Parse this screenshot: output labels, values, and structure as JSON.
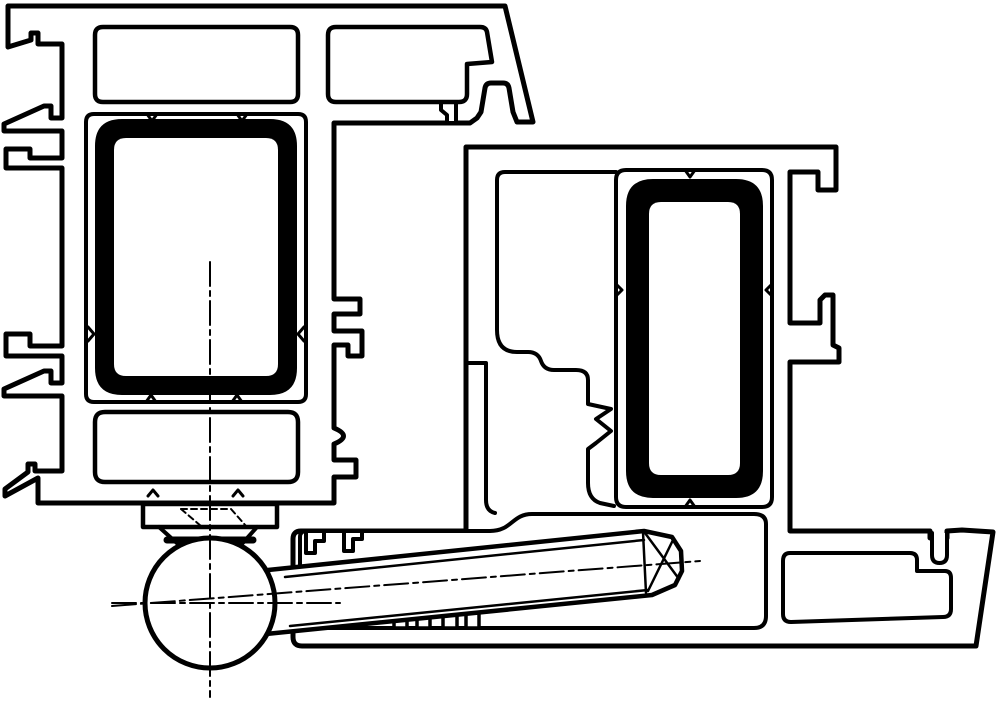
{
  "canvas": {
    "width": 1000,
    "height": 702,
    "background": "#ffffff"
  },
  "colors": {
    "line": "#000000",
    "fill": "#ffffff",
    "reinforcement": "#000000"
  },
  "drawing": {
    "kind": "technical-cross-section",
    "subject": "door-window-profile-hinge-section",
    "shapes": [
      {
        "name": "sash-profile-outline",
        "type": "path",
        "fill": "#ffffff",
        "sw": 5,
        "d": "M 8,6 L 505,6 L 533,122 L 517,122 L 513,112 L 509,88 Q 508,83 503,83 L 491,83 Q 486,83 485,88 L 481,112 L 477,118 L 470,123 L 334,123 L 334,299 L 360,299 L 360,314 L 334,314 L 334,331 L 362,331 L 362,356 L 348,356 L 348,345 L 334,345 L 334,428 Q 353,436 334,444 L 334,460 L 356,460 L 356,477 L 334,477 L 334,503 L 38,503 L 38,478 L 5,496 L 5,489 L 28,472 L 28,464 L 35,464 L 35,471 L 62,471 L 62,396 L 4,396 L 4,389 L 44,371 L 51,371 L 51,383 L 62,383 L 62,356 L 6,356 L 6,334 L 30,334 L 30,346 L 62,346 L 62,168 L 6,168 L 6,149 L 30,149 L 30,158 L 62,158 L 62,131 L 4,131 L 4,124 L 44,106 L 51,106 L 51,118 L 62,118 L 62,44 L 38,44 L 38,33 L 31,33 L 31,40 L 8,47 Z"
      },
      {
        "name": "sash-bead-hook",
        "type": "path",
        "fill": "#ffffff",
        "sw": 4,
        "d": "M 456,123 L 456,100 Q 456,92 448,92 Q 441,92 441,100 L 441,110 L 447,115 L 447,123 Z"
      },
      {
        "name": "sash-top-chamber-1",
        "type": "path",
        "fill": "#ffffff",
        "sw": 4.5,
        "d": "M 103,27 L 290,27 Q 298,27 298,35 L 298,94 Q 298,102 290,102 L 103,102 Q 95,102 95,94 L 95,35 Q 95,27 103,27 Z"
      },
      {
        "name": "sash-top-chamber-2",
        "type": "path",
        "fill": "#ffffff",
        "sw": 4.5,
        "d": "M 336,27 L 480,27 Q 486,27 487,32 L 492,62 L 467,64 L 467,94 Q 467,102 459,102 L 336,102 Q 328,102 328,94 L 328,35 Q 328,27 336,27 Z"
      },
      {
        "name": "sash-reinforcement-chamber",
        "type": "path",
        "fill": "#ffffff",
        "sw": 4,
        "d": "M 94,114 L 298,114 Q 306,114 306,122 L 306,394 Q 306,402 298,402 L 94,402 Q 86,402 86,394 L 86,122 Q 86,114 94,114 Z"
      },
      {
        "name": "steel-reinforcement-sash",
        "type": "path",
        "fill": "#000000",
        "stroke": "#000000",
        "sw": 2,
        "d": "M 122,120 L 270,120 Q 296,120 296,146 L 296,368 Q 296,394 270,394 L 122,394 Q 96,394 96,368 L 96,146 Q 96,120 122,120 Z"
      },
      {
        "name": "steel-reinforcement-sash-core",
        "type": "path",
        "fill": "#ffffff",
        "stroke": "none",
        "sw": 0,
        "d": "M 126,138 L 266,138 Q 278,138 278,150 L 278,364 Q 278,376 266,376 L 126,376 Q 114,376 114,364 L 114,150 Q 114,138 126,138 Z"
      },
      {
        "name": "sash-lower-chamber",
        "type": "path",
        "fill": "#ffffff",
        "sw": 4.5,
        "d": "M 105,412 L 288,412 Q 298,412 298,422 L 298,472 Q 298,482 288,482 L 105,482 Q 95,482 95,472 L 95,422 Q 95,412 105,412 Z"
      },
      {
        "name": "weld-notch-1",
        "type": "path",
        "fill": "none",
        "sw": 3,
        "d": "M 147,114 L 152,121 L 157,114"
      },
      {
        "name": "weld-notch-2",
        "type": "path",
        "fill": "none",
        "sw": 3,
        "d": "M 237,114 L 242,121 L 247,114"
      },
      {
        "name": "weld-notch-3",
        "type": "path",
        "fill": "none",
        "sw": 3,
        "d": "M 146,402 L 151,395 L 156,402"
      },
      {
        "name": "weld-notch-4",
        "type": "path",
        "fill": "none",
        "sw": 3,
        "d": "M 232,402 L 237,395 L 242,402"
      },
      {
        "name": "weld-notch-5",
        "type": "path",
        "fill": "none",
        "sw": 3,
        "d": "M 88,327 L 94,334 L 88,341"
      },
      {
        "name": "weld-notch-6",
        "type": "path",
        "fill": "none",
        "sw": 3,
        "d": "M 304,327 L 298,334 L 304,341"
      },
      {
        "name": "weld-notch-7",
        "type": "path",
        "fill": "none",
        "sw": 3,
        "d": "M 148,496 L 153,490 L 158,496"
      },
      {
        "name": "weld-notch-8",
        "type": "path",
        "fill": "none",
        "sw": 3,
        "d": "M 233,496 L 238,490 L 243,496"
      },
      {
        "name": "hinge-mount-plate",
        "type": "path",
        "fill": "#ffffff",
        "sw": 4.5,
        "d": "M 143,504 L 277,504 L 277,527 L 143,527 Z"
      },
      {
        "name": "hinge-mount-hidden-edge-1",
        "type": "path",
        "fill": "none",
        "sw": 2,
        "dash": "6 4",
        "d": "M 181,509 L 231,509"
      },
      {
        "name": "hinge-mount-hidden-edge-2",
        "type": "path",
        "fill": "none",
        "sw": 2,
        "dash": "6 4",
        "d": "M 181,509 L 201,526"
      },
      {
        "name": "hinge-mount-hidden-edge-3",
        "type": "path",
        "fill": "none",
        "sw": 2,
        "dash": "6 4",
        "d": "M 231,509 L 246,526"
      },
      {
        "name": "hinge-mount-hidden-edge-4",
        "type": "path",
        "fill": "none",
        "sw": 2,
        "dash": "6 4",
        "d": "M 206,526 L 219,526"
      },
      {
        "name": "hinge-mount-taper-left",
        "type": "path",
        "fill": "none",
        "sw": 4,
        "d": "M 159,527 L 179,545"
      },
      {
        "name": "hinge-mount-taper-right",
        "type": "path",
        "fill": "none",
        "sw": 4,
        "d": "M 257,527 L 241,545"
      },
      {
        "name": "hinge-mount-contact-band",
        "type": "path",
        "fill": "none",
        "sw": 7,
        "d": "M 167,540 L 253,540"
      },
      {
        "name": "frame-profile-outline",
        "type": "path",
        "fill": "#ffffff",
        "sw": 5,
        "d": "M 466,147 L 836,147 L 836,190 L 818,190 L 818,172 L 790,172 L 790,323 L 820,323 L 820,300 L 825,295 L 833,295 L 833,345 L 839,348 L 839,362 L 790,362 L 790,531 L 930,531 L 930,538 L 947,538 L 947,531 L 962,530 L 993,532 L 976,646 L 302,646 Q 293,646 293,637 L 293,539 Q 293,531 301,531 L 466,531 Z"
      },
      {
        "name": "frame-main-chamber",
        "type": "path",
        "fill": "none",
        "sw": 4,
        "d": "M 616,172 L 505,172 Q 497,172 497,180 L 497,330 Q 497,352 517,352 L 528,352 Q 538,352 541,361 Q 544,370 554,370 L 576,370 Q 588,370 588,380 L 588,404 L 611,409 L 596,419 L 611,431 L 596,443 L 588,449 L 588,483 Q 588,499 600,503 L 614,506"
      },
      {
        "name": "frame-foot-step",
        "type": "path",
        "fill": "none",
        "sw": 4,
        "d": "M 466,363 L 486,363 L 486,500 Q 486,511 495,513"
      },
      {
        "name": "frame-reinforcement-chamber",
        "type": "path",
        "fill": "#ffffff",
        "sw": 4,
        "d": "M 626,170 L 762,170 Q 772,170 772,180 L 772,497 Q 772,507 762,507 L 626,507 Q 616,507 616,497 L 616,180 Q 616,170 626,170 Z"
      },
      {
        "name": "steel-reinforcement-frame",
        "type": "path",
        "fill": "#000000",
        "stroke": "#000000",
        "sw": 2,
        "d": "M 653,180 L 736,180 Q 762,180 762,206 L 762,471 Q 762,497 736,497 L 653,497 Q 627,497 627,471 L 627,206 Q 627,180 653,180 Z"
      },
      {
        "name": "steel-reinforcement-frame-core",
        "type": "path",
        "fill": "#ffffff",
        "stroke": "none",
        "sw": 0,
        "d": "M 661,202 L 728,202 Q 740,202 740,214 L 740,463 Q 740,475 728,475 L 661,475 Q 649,475 649,463 L 649,214 Q 649,202 661,202 Z"
      },
      {
        "name": "weld-notch-9",
        "type": "path",
        "fill": "none",
        "sw": 3,
        "d": "M 685,170 L 690,177 L 695,170"
      },
      {
        "name": "weld-notch-10",
        "type": "path",
        "fill": "none",
        "sw": 3,
        "d": "M 616,284 L 622,290 L 616,296"
      },
      {
        "name": "weld-notch-11",
        "type": "path",
        "fill": "none",
        "sw": 3,
        "d": "M 772,284 L 766,290 L 772,296"
      },
      {
        "name": "weld-notch-12",
        "type": "path",
        "fill": "none",
        "sw": 3,
        "d": "M 685,507 L 690,500 L 695,507"
      },
      {
        "name": "threshold-chamber",
        "type": "path",
        "fill": "#ffffff",
        "sw": 4,
        "d": "M 306,531 L 490,531 C 512,531 512,514 532,514 L 754,514 Q 766,514 766,524 L 766,616 Q 766,628 754,628 L 310,628 Q 300,628 300,618 L 300,537 Q 300,531 306,531 Z"
      },
      {
        "name": "threshold-rib-1",
        "type": "rect",
        "x": 394,
        "y": 614,
        "w": 13,
        "h": 14,
        "fill": "#ffffff",
        "sw": 3.5
      },
      {
        "name": "threshold-rib-2",
        "type": "rect",
        "x": 417,
        "y": 614,
        "w": 13,
        "h": 14,
        "fill": "#ffffff",
        "sw": 3.5
      },
      {
        "name": "threshold-rib-3",
        "type": "rect",
        "x": 443,
        "y": 613,
        "w": 14,
        "h": 15,
        "fill": "#ffffff",
        "sw": 3.5
      },
      {
        "name": "threshold-rib-4",
        "type": "rect",
        "x": 466,
        "y": 613,
        "w": 13,
        "h": 15,
        "fill": "#ffffff",
        "sw": 3.5
      },
      {
        "name": "threshold-right-chamber",
        "type": "path",
        "fill": "#ffffff",
        "sw": 4,
        "d": "M 790,553 L 910,553 Q 917,553 917,560 L 917,571 L 945,571 Q 951,571 951,578 L 951,609 Q 951,617 943,617 L 791,622 Q 783,622 783,614 L 783,561 Q 783,553 790,553 Z"
      },
      {
        "name": "threshold-gasket-slot",
        "type": "path",
        "fill": "#ffffff",
        "sw": 4,
        "d": "M 932,533 L 932,555 Q 932,563 939.5,563 Q 947,563 947,555 L 947,533"
      },
      {
        "name": "hinge-arm",
        "type": "path",
        "fill": "#ffffff",
        "sw": 4.5,
        "d": "M 268,570 L 644,531 L 672,537 L 681,551 L 682,571 L 675,585 L 652,595 L 266,634 Z"
      },
      {
        "name": "hinge-arm-cap-edge",
        "type": "path",
        "fill": "none",
        "sw": 2.5,
        "d": "M 643,532 L 646,593"
      },
      {
        "name": "hinge-arm-top-edge",
        "type": "path",
        "fill": "none",
        "sw": 2.5,
        "d": "M 285,577 L 644,540"
      },
      {
        "name": "hinge-arm-bottom-edge",
        "type": "path",
        "fill": "none",
        "sw": 2.5,
        "d": "M 290,626 L 648,590"
      },
      {
        "name": "hinge-arm-tip-facet-1",
        "type": "path",
        "fill": "none",
        "sw": 2.5,
        "d": "M 645,533 L 679,579"
      },
      {
        "name": "hinge-arm-tip-facet-2",
        "type": "path",
        "fill": "none",
        "sw": 2.5,
        "d": "M 648,591 L 673,540"
      },
      {
        "name": "threshold-clip-tab-1",
        "type": "path",
        "fill": "#ffffff",
        "sw": 4,
        "d": "M 306,531 L 306,553 L 315,553 L 315,541 L 324,541 L 324,531 Z"
      },
      {
        "name": "threshold-clip-tab-2",
        "type": "path",
        "fill": "#ffffff",
        "sw": 4,
        "d": "M 344,531 L 344,551 L 353,551 L 353,539 L 362,539 L 362,531 Z"
      },
      {
        "name": "hinge-ball",
        "type": "circle",
        "cx": 210,
        "cy": 603,
        "r": 65,
        "fill": "#ffffff",
        "sw": 5
      },
      {
        "name": "center-line-vertical",
        "type": "path",
        "fill": "none",
        "sw": 2,
        "dash": "24 5 5 5",
        "d": "M 210,262 L 210,697"
      },
      {
        "name": "center-line-horizontal",
        "type": "path",
        "fill": "none",
        "sw": 2,
        "dash": "24 5 5 5",
        "d": "M 112,603 L 340,603"
      },
      {
        "name": "center-line-arm-axis",
        "type": "path",
        "fill": "none",
        "sw": 2,
        "dash": "24 5 5 5",
        "d": "M 112,606 L 700,561"
      }
    ]
  }
}
